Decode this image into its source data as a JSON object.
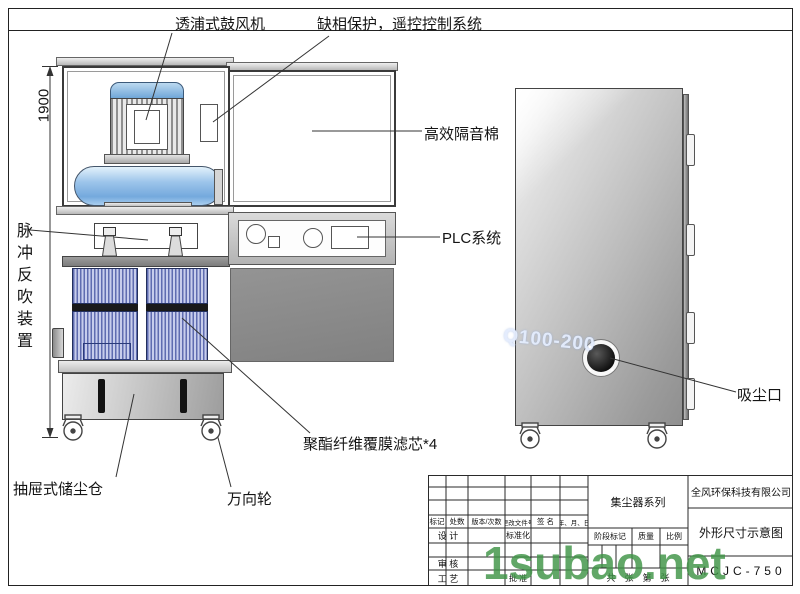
{
  "callouts": {
    "blower": "透浦式鼓风机",
    "phase_protection": "缺相保护，遥控控制系统",
    "soundproof_cotton": "高效隔音棉",
    "plc_system": "PLC系统",
    "pulse_backblow": "脉冲反吹装置",
    "filter_cartridge": "聚酯纤维覆膜滤芯*4",
    "dust_drawer": "抽屉式储尘仓",
    "caster": "万向轮",
    "suction_port": "吸尘口"
  },
  "dimensions": {
    "height": "1900"
  },
  "watermarks": {
    "cabinet_model": "Q100-200",
    "site": "1subao.net"
  },
  "title_block": {
    "product_series": "集尘器系列",
    "company": "全风环保科技有限公司",
    "drawing_title": "外形尺寸示意图",
    "model_no": "MCJC-750",
    "col_headers": {
      "mark": "标记",
      "qty": "处数",
      "version": "版本/次数",
      "change_file_no": "更改文件号",
      "signature": "签 名",
      "date": "年、月、日"
    },
    "row_labels": {
      "design": "设 计",
      "standardize": "标准化",
      "review": "审 核",
      "process": "工 艺",
      "approve": "批 准"
    },
    "stage": {
      "stage_mark": "阶段标记",
      "quality": "质量",
      "scale": "比例"
    },
    "sheet_info": "共　张　第　张"
  },
  "colors": {
    "accent_blue": "#6fa8dc",
    "filter_blue": "#5f6cb0",
    "watermark_green": "#3fa14c",
    "metal_grey": "#b5b5b5"
  }
}
